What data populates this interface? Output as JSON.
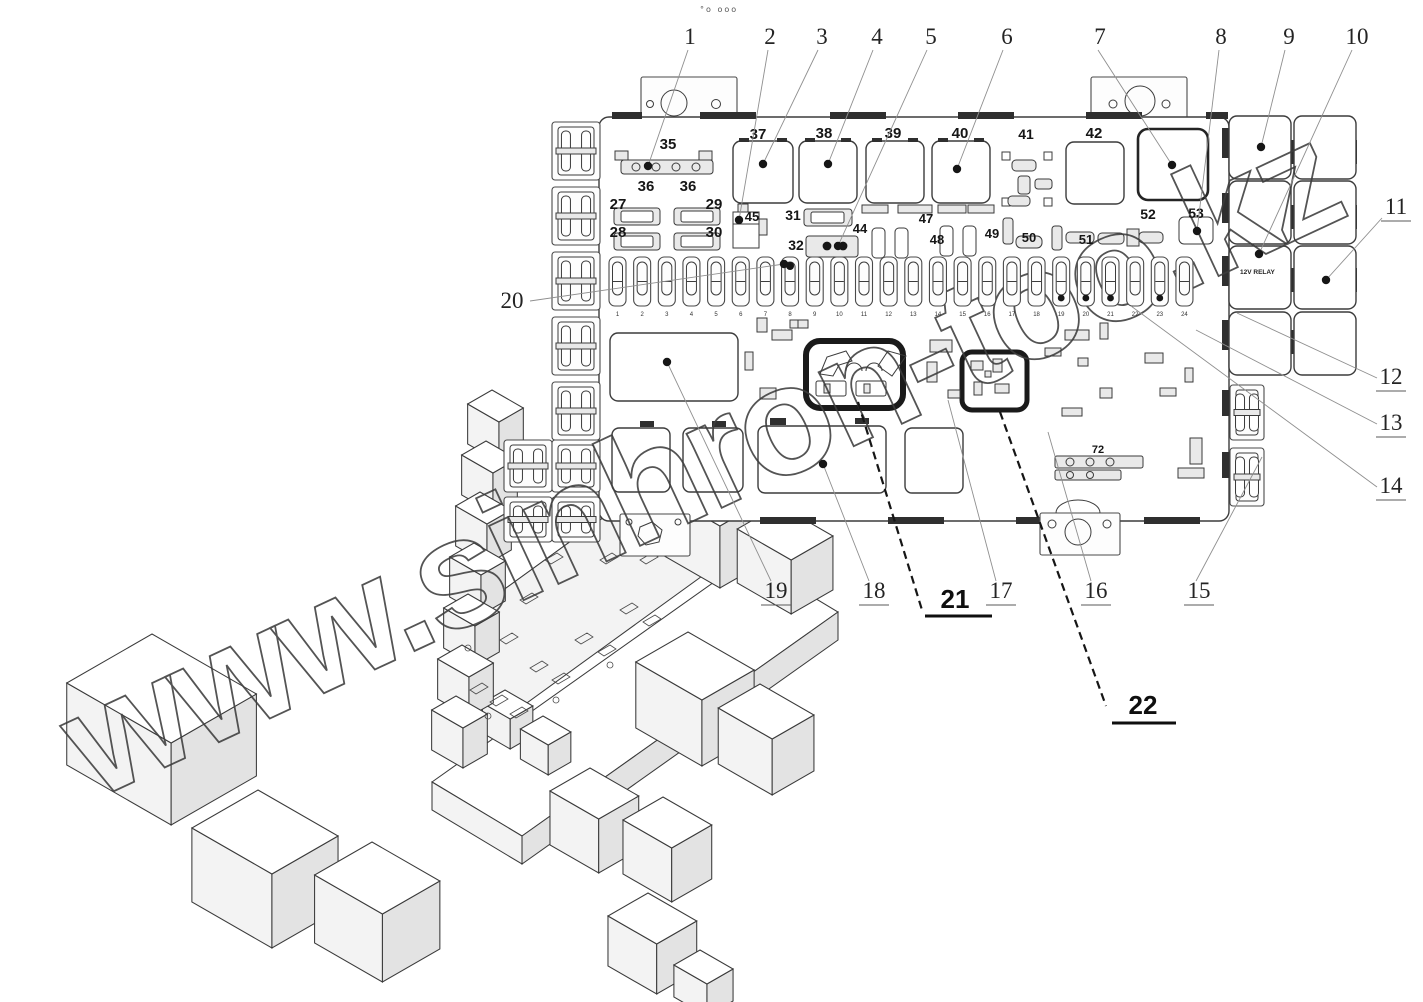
{
  "watermark": {
    "text": "www.sinhron-too.kz"
  },
  "top_artifact": "°o ooo",
  "relay_cell_text": "12V RELAY",
  "view_2d": {
    "callouts": [
      {
        "n": "1",
        "lx": 690,
        "ly": 44,
        "sx": 688,
        "sy": 50,
        "x2": 648,
        "y2": 166,
        "dot": true
      },
      {
        "n": "2",
        "lx": 770,
        "ly": 44,
        "sx": 768,
        "sy": 50,
        "x2": 739,
        "y2": 220,
        "dot": true
      },
      {
        "n": "3",
        "lx": 822,
        "ly": 44,
        "sx": 818,
        "sy": 50,
        "x2": 763,
        "y2": 164,
        "dot": true
      },
      {
        "n": "4",
        "lx": 877,
        "ly": 44,
        "sx": 873,
        "sy": 50,
        "x2": 828,
        "y2": 164,
        "dot": true
      },
      {
        "n": "5",
        "lx": 931,
        "ly": 44,
        "sx": 927,
        "sy": 50,
        "x2": 838,
        "y2": 246,
        "dot": true
      },
      {
        "n": "6",
        "lx": 1007,
        "ly": 44,
        "sx": 1003,
        "sy": 50,
        "x2": 957,
        "y2": 169,
        "dot": true
      },
      {
        "n": "7",
        "lx": 1100,
        "ly": 44,
        "sx": 1098,
        "sy": 50,
        "x2": 1172,
        "y2": 165,
        "dot": true
      },
      {
        "n": "8",
        "lx": 1221,
        "ly": 44,
        "sx": 1219,
        "sy": 50,
        "x2": 1197,
        "y2": 231,
        "dot": true
      },
      {
        "n": "9",
        "lx": 1289,
        "ly": 44,
        "sx": 1285,
        "sy": 50,
        "x2": 1261,
        "y2": 147,
        "dot": true
      },
      {
        "n": "10",
        "lx": 1357,
        "ly": 44,
        "sx": 1352,
        "sy": 50,
        "x2": 1259,
        "y2": 254,
        "dot": true
      },
      {
        "n": "11",
        "lx": 1396,
        "ly": 214,
        "sx": 1382,
        "sy": 218,
        "x2": 1326,
        "y2": 280,
        "dot": true,
        "u": true
      },
      {
        "n": "12",
        "lx": 1391,
        "ly": 384,
        "sx": 1377,
        "sy": 378,
        "x2": 1237,
        "y2": 313,
        "dot": false,
        "u": true
      },
      {
        "n": "13",
        "lx": 1391,
        "ly": 430,
        "sx": 1377,
        "sy": 424,
        "x2": 1196,
        "y2": 330,
        "dot": false,
        "u": true
      },
      {
        "n": "14",
        "lx": 1391,
        "ly": 493,
        "sx": 1377,
        "sy": 487,
        "x2": 1131,
        "y2": 306,
        "dot": false,
        "u": true
      },
      {
        "n": "15",
        "lx": 1199,
        "ly": 598,
        "sx": 1196,
        "sy": 581,
        "x2": 1262,
        "y2": 457,
        "dot": false,
        "u": true
      },
      {
        "n": "16",
        "lx": 1096,
        "ly": 598,
        "sx": 1091,
        "sy": 581,
        "x2": 1048,
        "y2": 432,
        "dot": false,
        "u": true
      },
      {
        "n": "17",
        "lx": 1001,
        "ly": 598,
        "sx": 996,
        "sy": 581,
        "x2": 948,
        "y2": 400,
        "dot": false,
        "u": true
      },
      {
        "n": "18",
        "lx": 874,
        "ly": 598,
        "sx": 869,
        "sy": 581,
        "x2": 823,
        "y2": 464,
        "dot": true,
        "u": true
      },
      {
        "n": "19",
        "lx": 776,
        "ly": 598,
        "sx": 771,
        "sy": 581,
        "x2": 667,
        "y2": 362,
        "dot": true,
        "u": true
      },
      {
        "n": "20",
        "lx": 512,
        "ly": 308,
        "sx": 530,
        "sy": 301,
        "x2": 784,
        "y2": 264,
        "dot": true
      }
    ],
    "bold_callouts": [
      {
        "n": "21",
        "lx": 955,
        "ly": 608,
        "ux1": 925,
        "ux2": 992,
        "uy": 616,
        "sx": 858,
        "sy": 402,
        "x2": 922,
        "y2": 610
      },
      {
        "n": "22",
        "lx": 1143,
        "ly": 714,
        "ux1": 1112,
        "ux2": 1176,
        "uy": 723,
        "sx": 1000,
        "sy": 412,
        "x2": 1106,
        "y2": 706
      }
    ],
    "part_labels": [
      {
        "t": "35",
        "x": 668,
        "y": 149,
        "s": 15
      },
      {
        "t": "36",
        "x": 646,
        "y": 191,
        "s": 15
      },
      {
        "t": "36",
        "x": 688,
        "y": 191,
        "s": 15
      },
      {
        "t": "27",
        "x": 618,
        "y": 209,
        "s": 15
      },
      {
        "t": "28",
        "x": 618,
        "y": 237,
        "s": 15
      },
      {
        "t": "29",
        "x": 714,
        "y": 209,
        "s": 15
      },
      {
        "t": "30",
        "x": 714,
        "y": 237,
        "s": 15
      },
      {
        "t": "37",
        "x": 758,
        "y": 139,
        "s": 15
      },
      {
        "t": "38",
        "x": 824,
        "y": 138,
        "s": 15
      },
      {
        "t": "39",
        "x": 893,
        "y": 138,
        "s": 15
      },
      {
        "t": "40",
        "x": 960,
        "y": 138,
        "s": 15
      },
      {
        "t": "41",
        "x": 1026,
        "y": 139,
        "s": 14
      },
      {
        "t": "42",
        "x": 1094,
        "y": 138,
        "s": 15
      },
      {
        "t": "45",
        "x": 752,
        "y": 221,
        "s": 13
      },
      {
        "t": "31",
        "x": 793,
        "y": 220,
        "s": 14
      },
      {
        "t": "32",
        "x": 796,
        "y": 250,
        "s": 14
      },
      {
        "t": "44",
        "x": 860,
        "y": 233,
        "s": 13
      },
      {
        "t": "47",
        "x": 926,
        "y": 223,
        "s": 13
      },
      {
        "t": "48",
        "x": 937,
        "y": 244,
        "s": 13
      },
      {
        "t": "49",
        "x": 992,
        "y": 238,
        "s": 13
      },
      {
        "t": "50",
        "x": 1029,
        "y": 242,
        "s": 13
      },
      {
        "t": "51",
        "x": 1086,
        "y": 244,
        "s": 13
      },
      {
        "t": "52",
        "x": 1148,
        "y": 219,
        "s": 14
      },
      {
        "t": "53",
        "x": 1196,
        "y": 218,
        "s": 14
      },
      {
        "t": "72",
        "x": 1098,
        "y": 453,
        "s": 11
      }
    ],
    "fuse_row": {
      "x0": 609,
      "y": 257,
      "w": 17,
      "h": 49,
      "pitch": 24.65,
      "numbers": [
        "1",
        "2",
        "3",
        "4",
        "5",
        "6",
        "7",
        "8",
        "9",
        "10",
        "11",
        "12",
        "13",
        "14",
        "15",
        "16",
        "17",
        "18",
        "19",
        "20",
        "21",
        "22",
        "23",
        "24"
      ],
      "shaded": [
        17,
        18,
        22,
        24
      ],
      "top_dots": [
        8
      ],
      "bottom_dots": [
        19,
        20,
        21,
        23
      ]
    }
  }
}
